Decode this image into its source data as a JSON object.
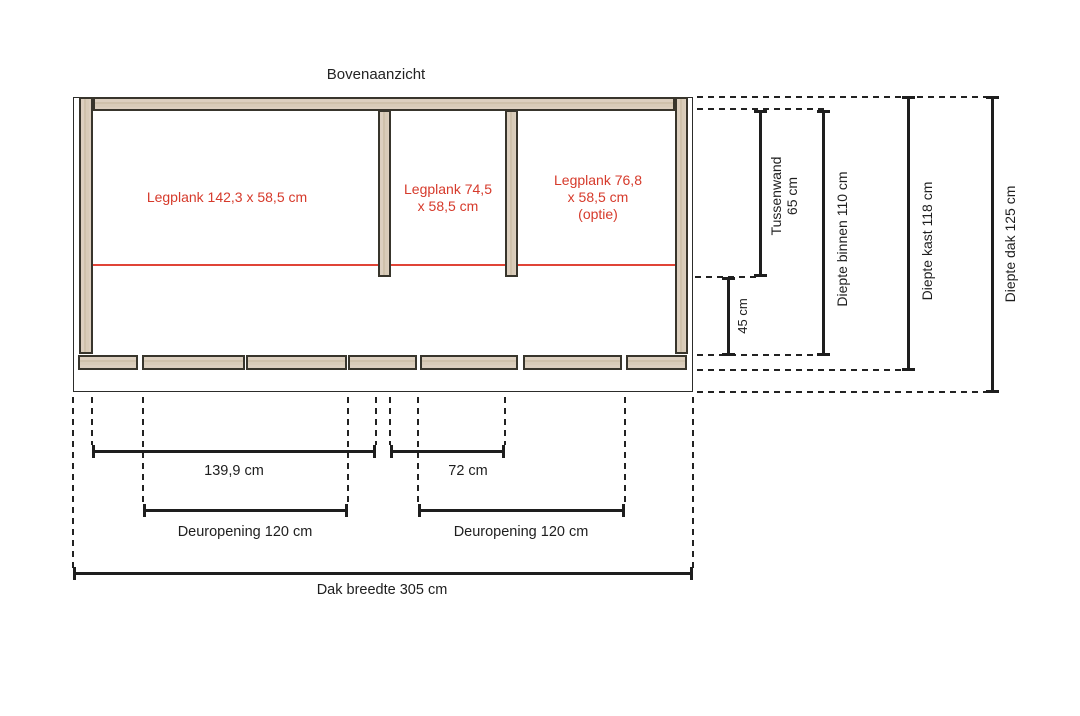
{
  "title": "Bovenaanzicht",
  "colors": {
    "accent_red": "#d63a2b",
    "wood_fill": "#d7cab7",
    "line": "#1e1e1e"
  },
  "shelves": [
    {
      "line1": "Legplank 142,3 x 58,5 cm"
    },
    {
      "line1": "Legplank 74,5",
      "line2": "x 58,5 cm"
    },
    {
      "line1": "Legplank 76,8",
      "line2": "x 58,5 cm",
      "line3": "(optie)"
    }
  ],
  "side_dims": {
    "tussenwand": {
      "line1": "Tussenwand",
      "line2": "65 cm"
    },
    "h45": {
      "line1": "45 cm"
    },
    "binnen": {
      "line1": "Diepte binnen 110 cm"
    },
    "kast": {
      "line1": "Diepte kast 118 cm"
    },
    "dak": {
      "line1": "Diepte dak 125 cm"
    }
  },
  "bottom_dims": {
    "shelf_left": "139,9 cm",
    "shelf_mid": "72 cm",
    "door_left": "Deuropening 120 cm",
    "door_right": "Deuropening 120 cm",
    "roof_width": "Dak breedte 305 cm"
  }
}
